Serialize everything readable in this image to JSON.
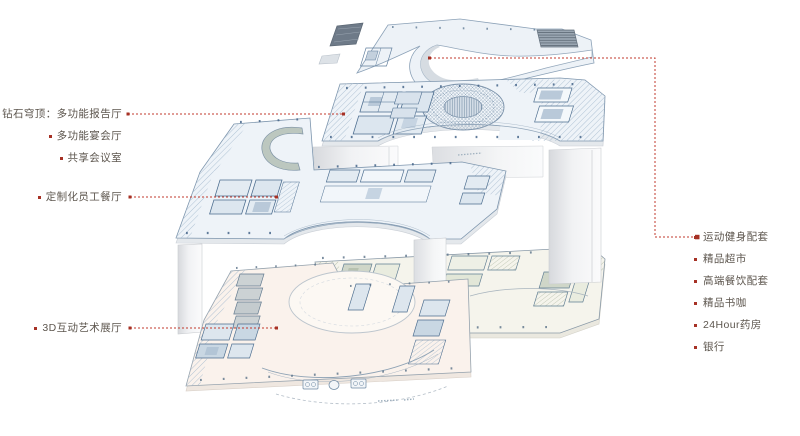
{
  "page": {
    "background": "#ffffff",
    "width": 800,
    "height": 436
  },
  "diagram": {
    "type": "exploded-axonometric-floor-plan-diagram",
    "colors": {
      "accent_red": "#c13a2c",
      "dot_red": "#a63125",
      "text": "#5d564e",
      "plate_blue": "#eef3f8",
      "plate_cream": "#f5f4ec",
      "plate_pink": "#faf2ec",
      "line_blue": "#7d95ad"
    },
    "icons": {
      "label_bullet": "bullet-square",
      "leader_terminal": "arrow-dot"
    },
    "left_annotations": [
      {
        "text": "钻石穹顶：多功能报告厅",
        "y": 114
      },
      {
        "text": "多功能宴会厅",
        "y": 136
      },
      {
        "text": "共享会议室",
        "y": 158
      },
      {
        "text": "定制化员工餐厅",
        "y": 197
      },
      {
        "text": "3D互动艺术展厅",
        "y": 328
      }
    ],
    "right_annotations": [
      {
        "text": "运动健身配套",
        "y": 237
      },
      {
        "text": "精品超市",
        "y": 259
      },
      {
        "text": "高端餐饮配套",
        "y": 281
      },
      {
        "text": "精品书咖",
        "y": 303
      },
      {
        "text": "24Hour药房",
        "y": 325
      },
      {
        "text": "银行",
        "y": 347
      }
    ]
  }
}
